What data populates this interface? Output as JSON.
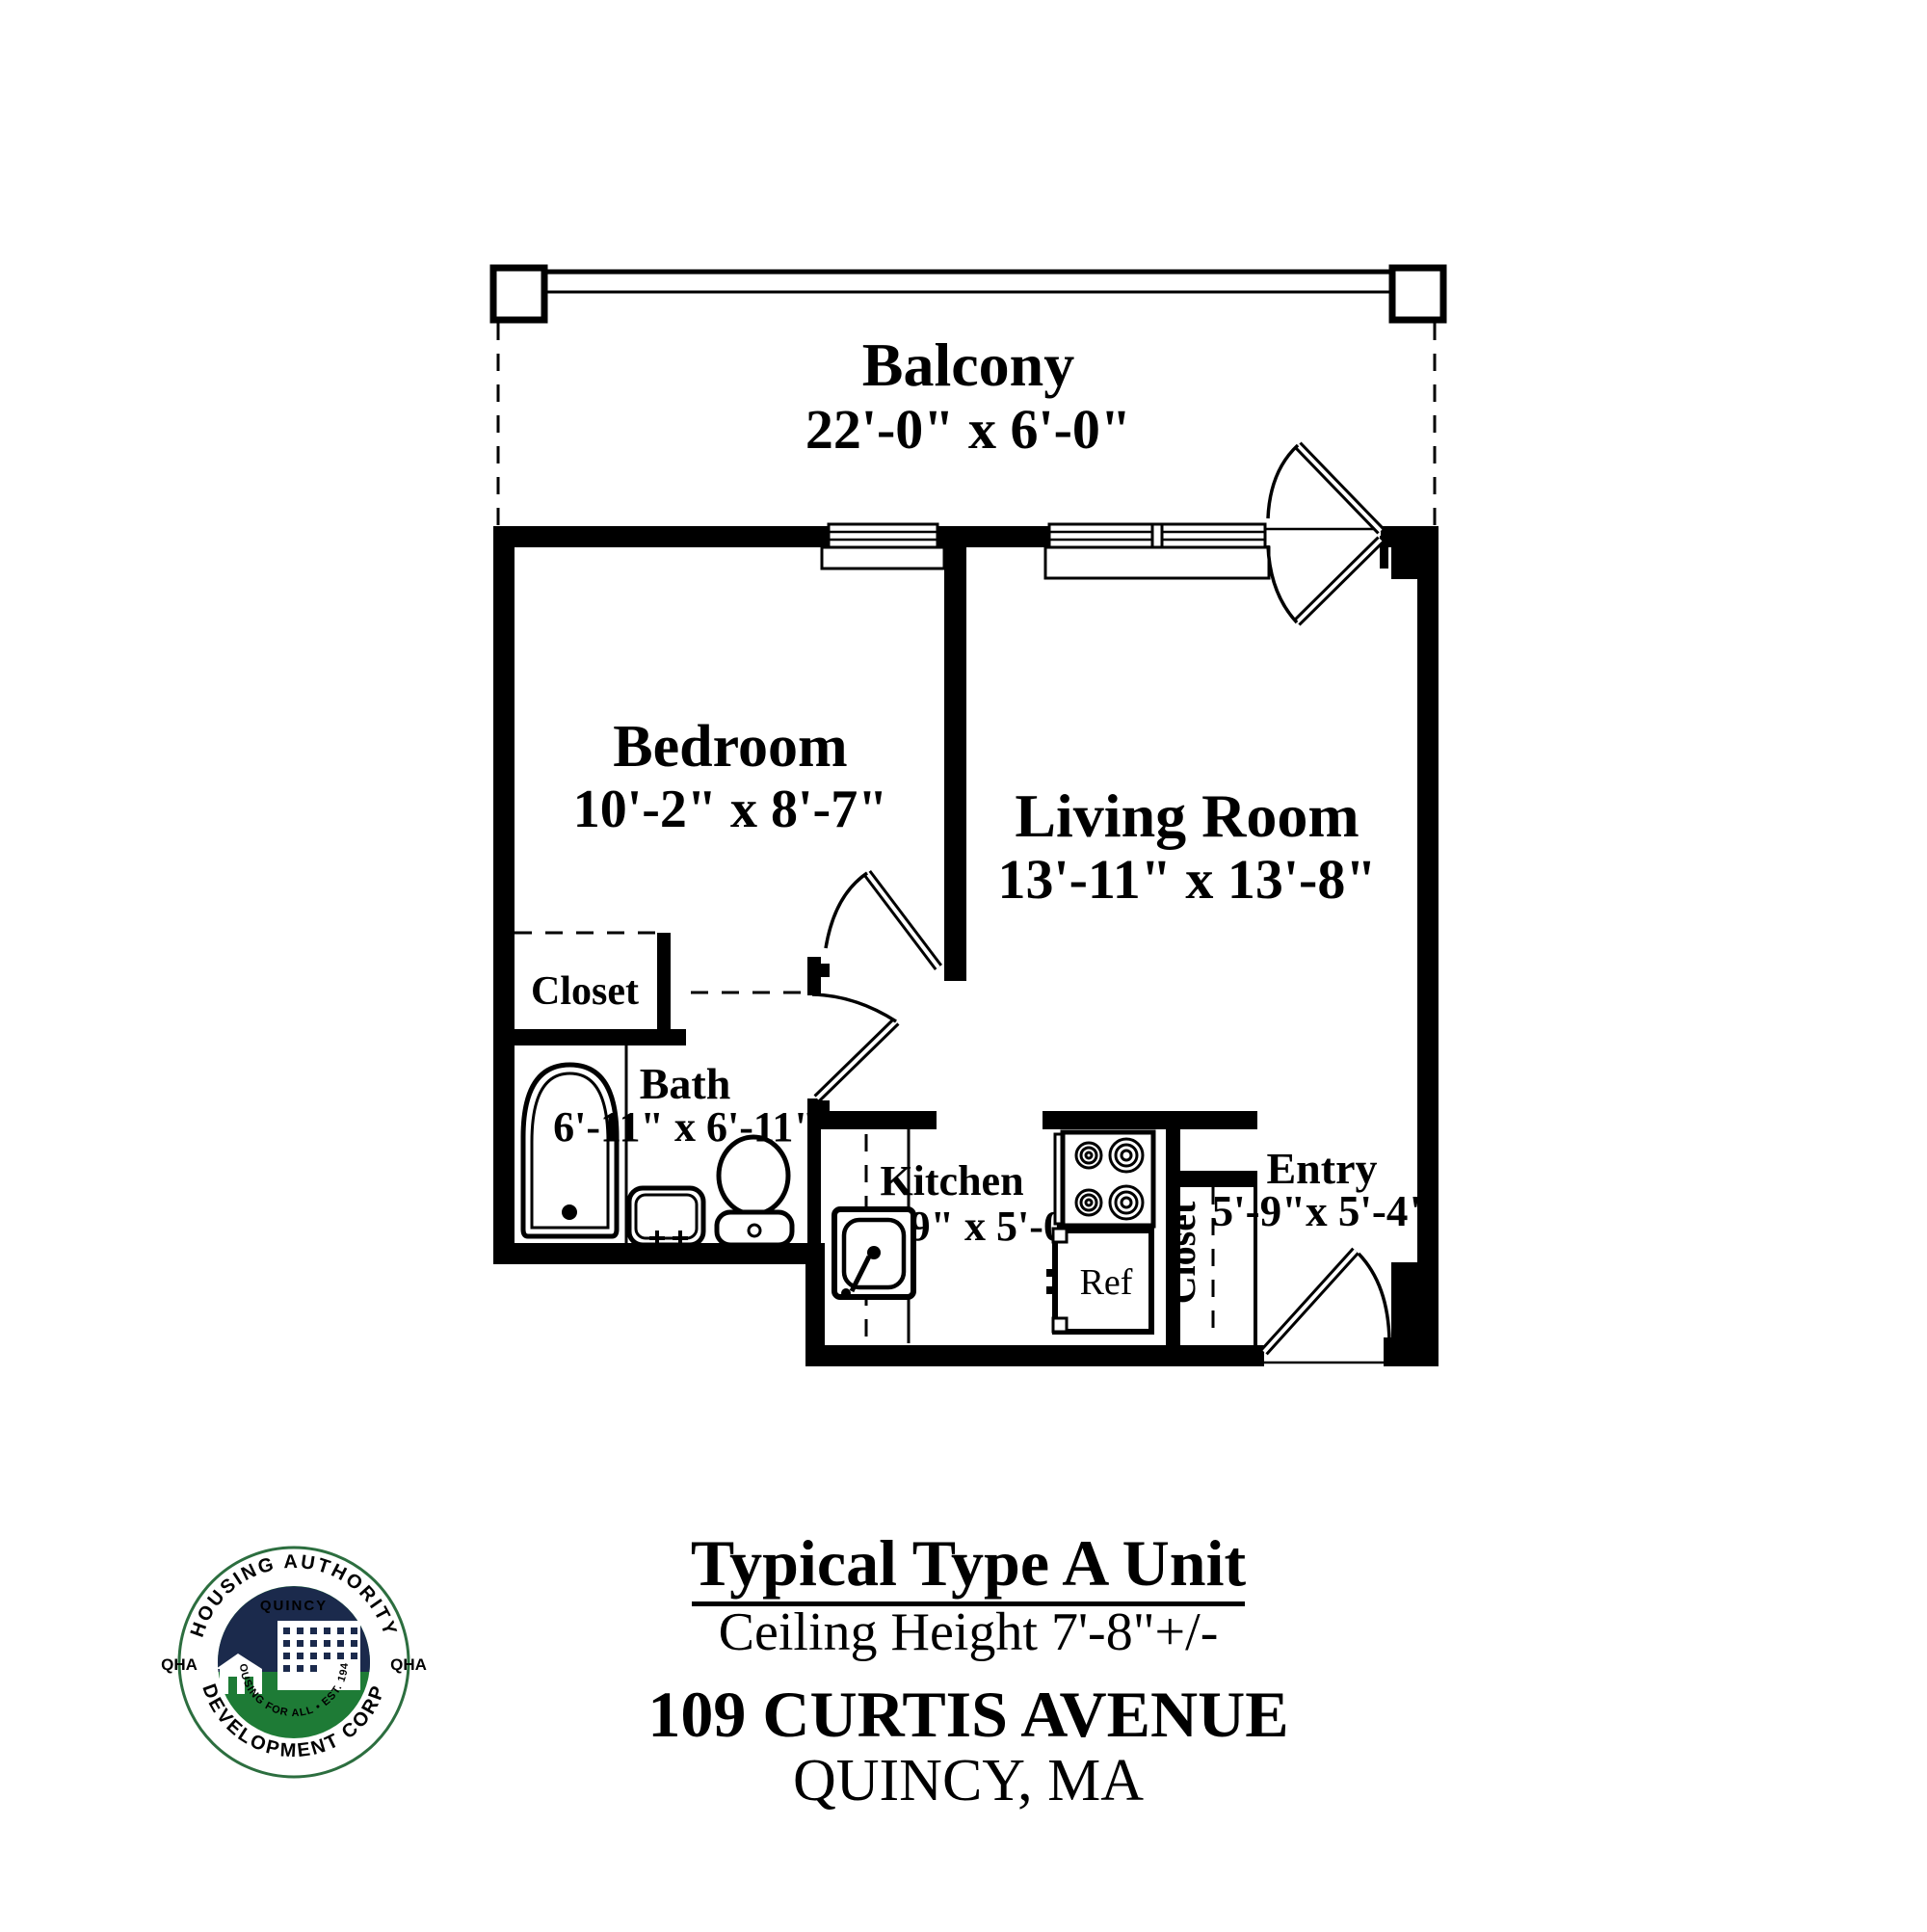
{
  "floor_plan": {
    "balcony": {
      "name": "Balcony",
      "dims": "22'-0\" x 6'-0\""
    },
    "bedroom": {
      "name": "Bedroom",
      "dims": "10'-2\" x 8'-7\""
    },
    "living_room": {
      "name": "Living Room",
      "dims": "13'-11\" x 13'-8\""
    },
    "bedroom_closet": {
      "name": "Closet"
    },
    "bath": {
      "name": "Bath",
      "dims": "6'-11\" x 6'-11\""
    },
    "kitchen": {
      "name": "Kitchen",
      "dims": "7'-9\" x 5'-0\""
    },
    "entry": {
      "name": "Entry",
      "dims": "5'-9\"x 5'-4\""
    },
    "entry_closet": {
      "name": "Closet"
    },
    "refrigerator": {
      "label": "Ref"
    }
  },
  "title_block": {
    "title": "Typical Type A Unit",
    "subtitle": "Ceiling Height 7'-8\"+/-",
    "address": "109 CURTIS AVENUE",
    "city": "QUINCY, MA"
  },
  "logo": {
    "top_arc": "HOUSING AUTHORITY",
    "bottom_arc": "DEVELOPMENT CORP",
    "left_text": "QHA",
    "right_text": "QHA",
    "city": "QUINCY",
    "motto": "HOUSING FOR ALL • EST. 1945"
  },
  "colors": {
    "line": "#000000",
    "background": "#ffffff",
    "logo_navy": "#1b2a4c",
    "logo_green": "#1e7b36",
    "logo_ring": "#2c6e3f"
  }
}
